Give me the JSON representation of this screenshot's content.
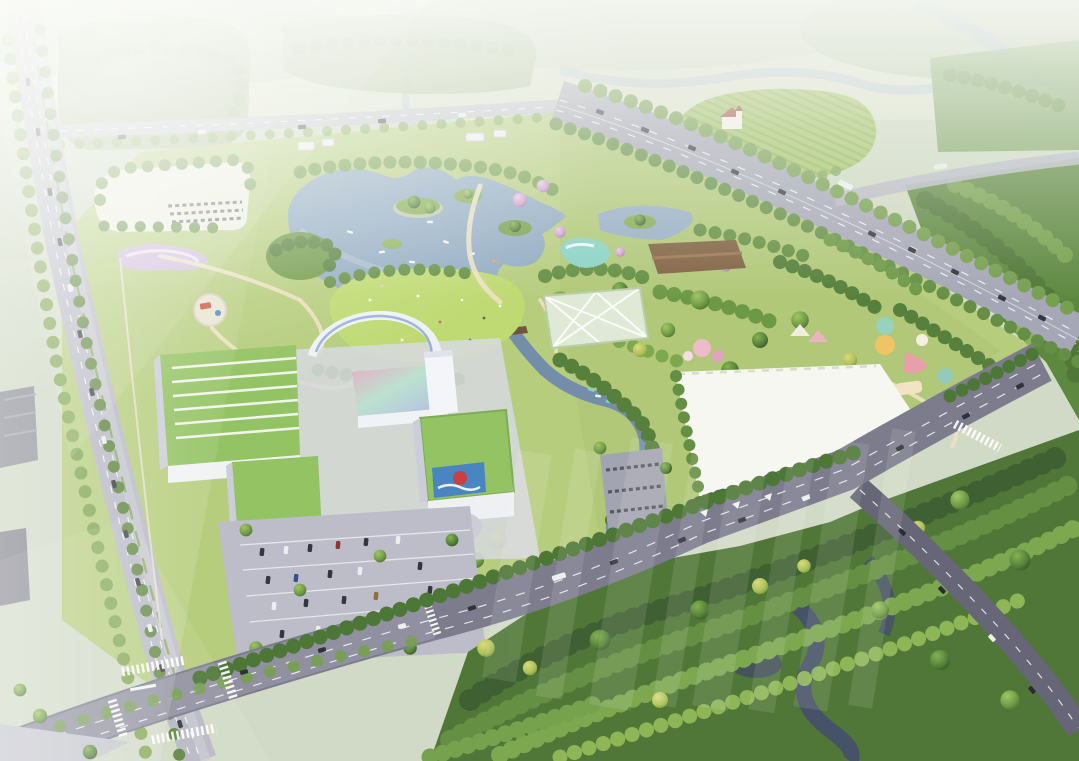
{
  "scene": {
    "type": "aerial-architectural-rendering",
    "description": "Bird's-eye masterplan rendering of a lakeside leisure park: hazy farmland and forest belts at top, a tree-lined avenue on the left, a diagonal highway at upper right, a central lake with islands and boats, a lawn amphitheater with arc promenade, white mall buildings with green roofs, a large white event plaza, playground attractions, a front boulevard and dense dark forest at bottom right, with a faint translucent watermark over the lower middle."
  },
  "watermark": {
    "present": true,
    "style": "translucent-bars",
    "color": "#ffffff"
  },
  "palette": {
    "distant_green": "#a2b58c",
    "field_pale": "#d9dfc9",
    "park_green": "#b3cb79",
    "lawn_green": "#bcd96e",
    "lake_blue": "#8ca7c2",
    "stream_blue": "#6d88a8",
    "stream_dark": "#3d4962",
    "road_light": "#b4b5c4",
    "road_mid": "#a2a3b5",
    "road_boulevard": "#75758a",
    "road_forest": "#5e5e72",
    "building_white": "#f1f2f7",
    "roof_green": "#8ec05c",
    "plaza_white": "#f6f7f2",
    "canopy_brown": "#7b5b3c",
    "pool_teal": "#85d1c5",
    "billboard_blue": "#3f7fc0",
    "logo_red": "#c93538",
    "forest_dark": "#47702f",
    "car_dark": "#2a2d38",
    "blossom_pink": "#cfa3d4"
  }
}
